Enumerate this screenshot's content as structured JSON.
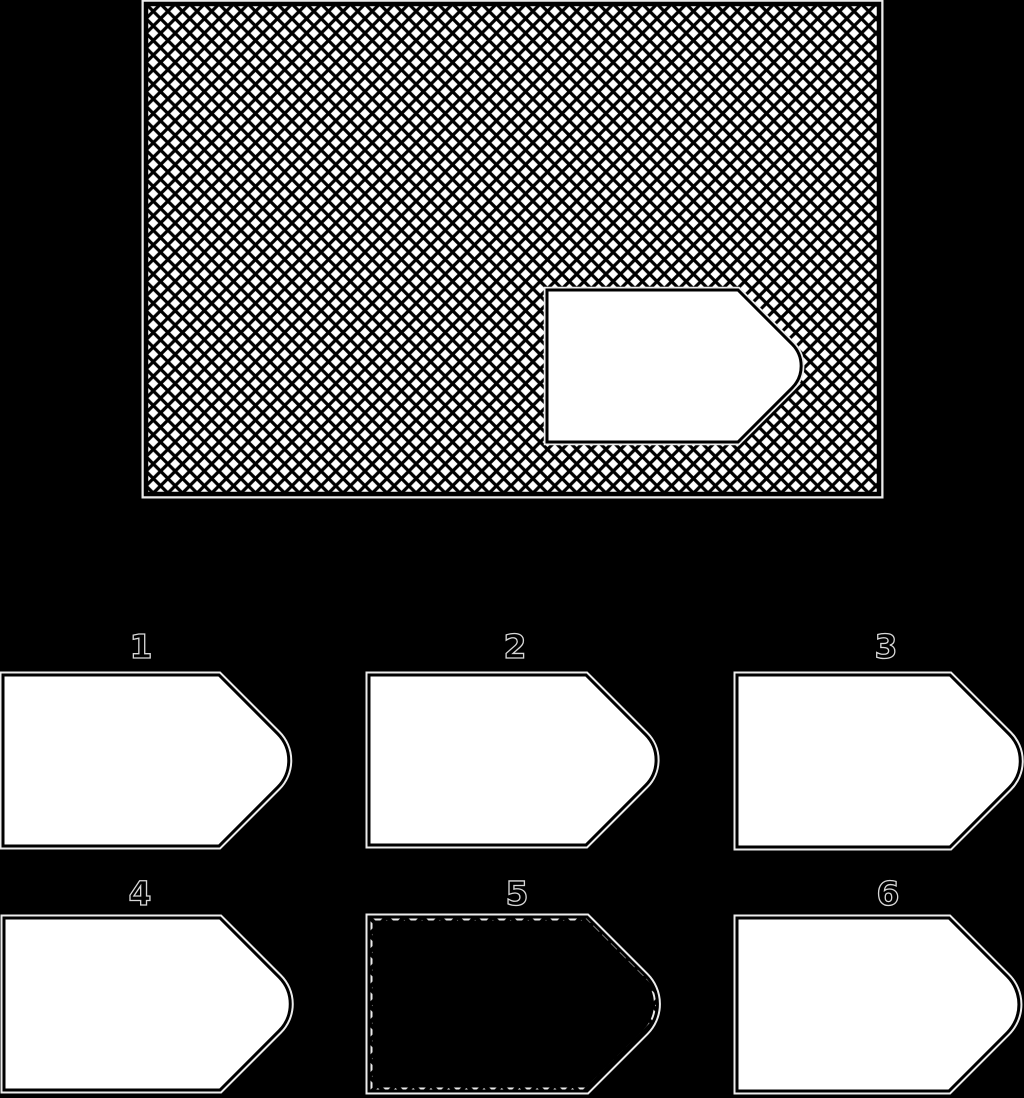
{
  "background_color": "#000000",
  "palette": {
    "shape_fill": "#ffffff",
    "outline": "#000000",
    "halo": "#ededed",
    "label_fill": "#000000",
    "label_outline": "#d8d8d8"
  },
  "panel": {
    "x": 146,
    "y": 4,
    "width": 733,
    "height": 490,
    "border_width": 4.5,
    "hatch": {
      "period": 14.6,
      "line_width": 3.2
    },
    "cutout": {
      "x": 547,
      "y": 290,
      "rect_width": 191,
      "height": 152,
      "tip_radius": 31,
      "stroke_width": 3
    }
  },
  "options": [
    {
      "label": "1",
      "x": 3,
      "y": 675,
      "rect_width": 216,
      "height": 171,
      "tip_radius": 38,
      "filled": false,
      "label_x": 141,
      "label_baseline": 658
    },
    {
      "label": "2",
      "x": 369,
      "y": 675,
      "rect_width": 217,
      "height": 170,
      "tip_radius": 36,
      "filled": false,
      "label_x": 515,
      "label_baseline": 658
    },
    {
      "label": "3",
      "x": 737,
      "y": 675,
      "rect_width": 213,
      "height": 172,
      "tip_radius": 38,
      "filled": false,
      "label_x": 886,
      "label_baseline": 658
    },
    {
      "label": "4",
      "x": 4,
      "y": 918,
      "rect_width": 216,
      "height": 172,
      "tip_radius": 38,
      "filled": false,
      "label_x": 140,
      "label_baseline": 905
    },
    {
      "label": "5",
      "x": 369,
      "y": 917,
      "rect_width": 218,
      "height": 174,
      "tip_radius": 40,
      "filled": true,
      "label_x": 517,
      "label_baseline": 905,
      "hatch": {
        "period": 17.7,
        "line_width": 4
      }
    },
    {
      "label": "6",
      "x": 737,
      "y": 918,
      "rect_width": 212,
      "height": 173,
      "tip_radius": 40,
      "filled": false,
      "label_x": 888,
      "label_baseline": 905
    }
  ]
}
